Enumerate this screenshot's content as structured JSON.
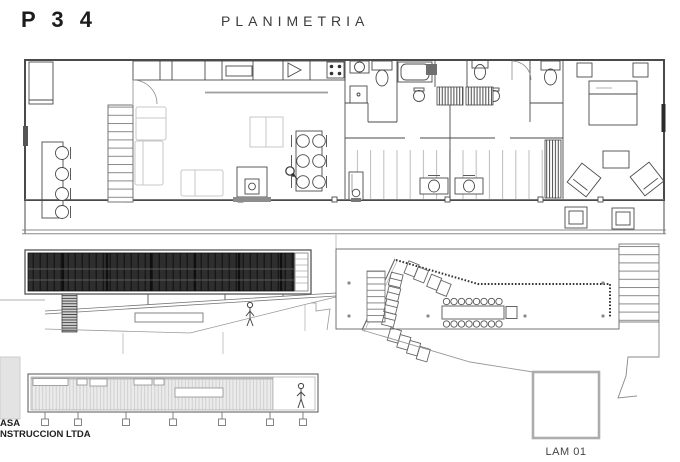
{
  "header": {
    "sheet_code": "P 3 4",
    "title": "PLANIMETRIA"
  },
  "title_block": {
    "firm_line1": "ASA",
    "firm_line2": "NSTRUCCION LTDA",
    "sheet_label": "LAM 01"
  },
  "colors": {
    "ink": "#4a4a4a",
    "dark_cladding": "#2e2e2e",
    "light_cladding": "#ebebeb",
    "ghost_furniture": "#c7c7c7",
    "page": "#ffffff"
  }
}
